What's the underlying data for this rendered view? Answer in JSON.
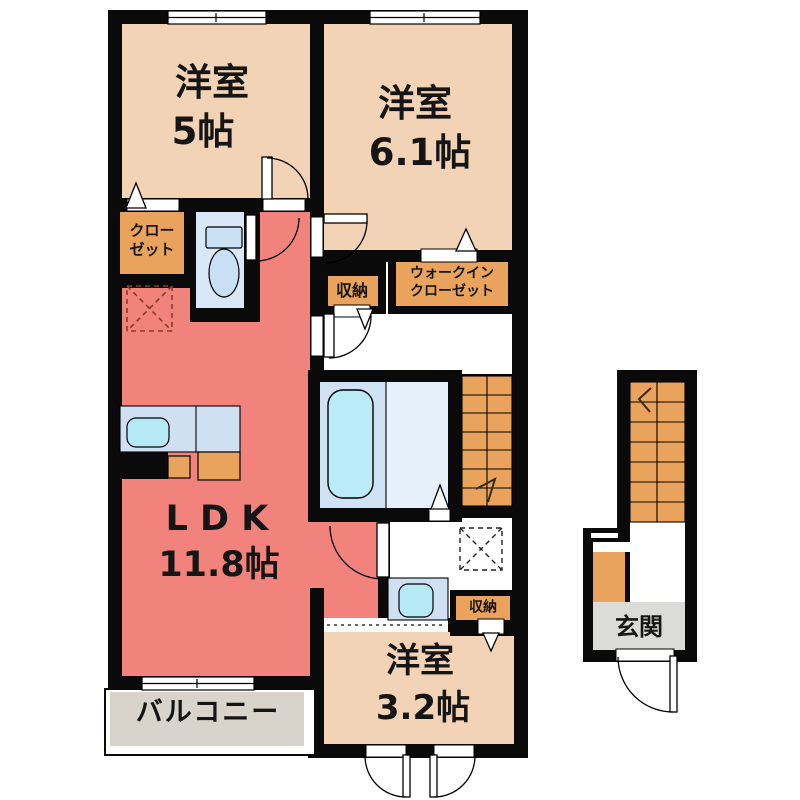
{
  "rooms": {
    "bedroom1": {
      "label": "洋室",
      "size": "5帖"
    },
    "bedroom2": {
      "label": "洋室",
      "size": "6.1帖"
    },
    "bedroom3": {
      "label": "洋室",
      "size": "3.2帖"
    },
    "ldk": {
      "label": "L D K",
      "size": "11.8帖"
    },
    "balcony": {
      "label": "バルコニー"
    },
    "entrance": {
      "label": "玄関"
    },
    "closet": {
      "line1": "クロー",
      "line2": "ゼット"
    },
    "walk_in_closet": {
      "line1": "ウォークイン",
      "line2": "クローゼット"
    },
    "storage_hall": {
      "label": "収納"
    },
    "storage_washroom": {
      "label": "収納"
    }
  },
  "colors": {
    "wall": "#0a0a0a",
    "bedroom_floor": "#f2d3b5",
    "ldk_floor": "#f2837c",
    "storage_orange": "#e9a35c",
    "stairs_orange": "#e9a35c",
    "toilet_floor": "#d9e7f7",
    "bath_floor_left": "#cfe2f4",
    "bath_floor_right": "#e6f0fa",
    "bathtub": "#b9ecf6",
    "fixture_blue": "#b6e9f6",
    "counter_blue": "#cfe0f3",
    "balcony_floor": "#d9d4cb",
    "entrance_floor": "#dbdbd9"
  }
}
